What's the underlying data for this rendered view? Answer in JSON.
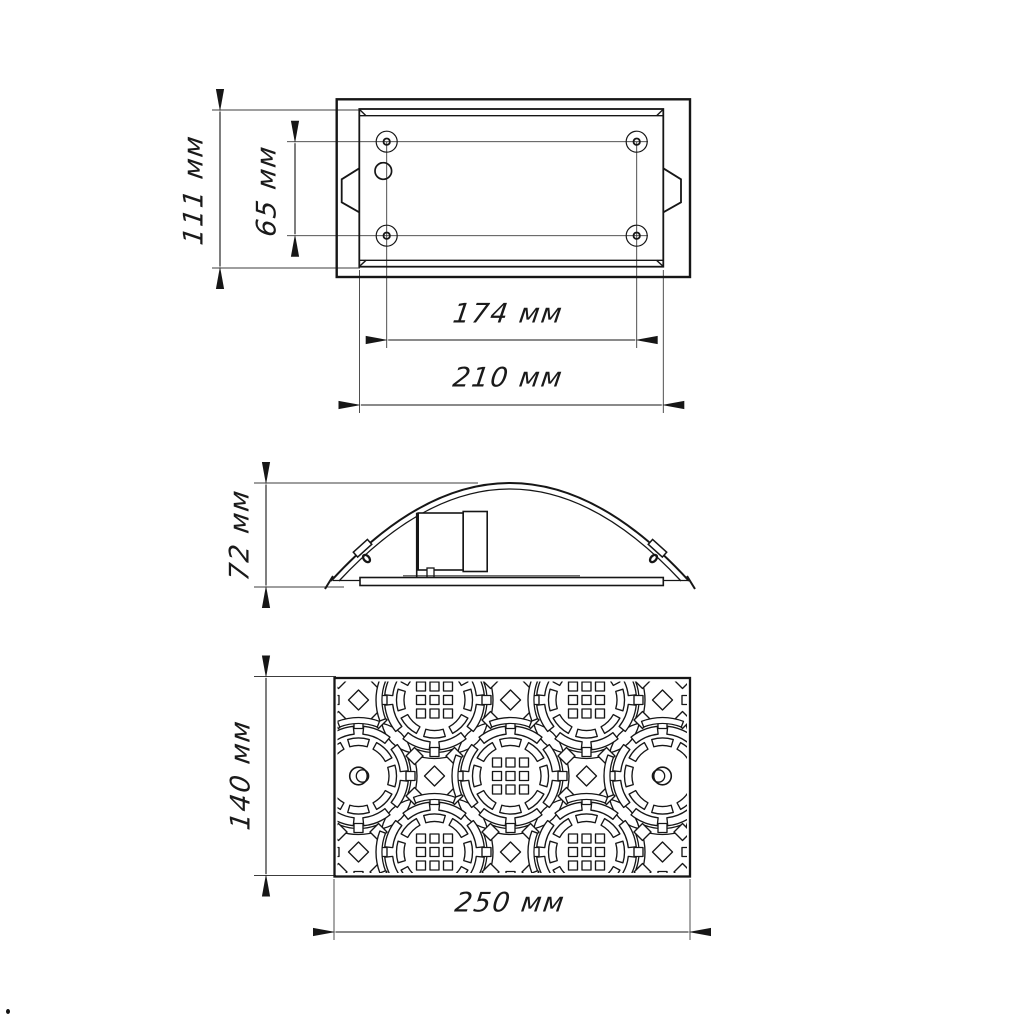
{
  "units": "мм",
  "colors": {
    "line": "#161616",
    "thin_line": "#3c3c3c",
    "background": "#ffffff"
  },
  "views": {
    "top_view": {
      "dimensions": {
        "body_height": {
          "label": "111 мм",
          "value": 111,
          "unit": "мм"
        },
        "hole_spacing_vertical": {
          "label": "65 мм",
          "value": 65,
          "unit": "мм"
        },
        "hole_spacing_horizontal": {
          "label": "174 мм",
          "value": 174,
          "unit": "мм"
        },
        "body_width": {
          "label": "210 мм",
          "value": 210,
          "unit": "мм"
        }
      }
    },
    "side_view": {
      "dimensions": {
        "profile_height": {
          "label": "72 мм",
          "value": 72,
          "unit": "мм"
        }
      }
    },
    "front_view": {
      "dimensions": {
        "grille_height": {
          "label": "140 мм",
          "value": 140,
          "unit": "мм"
        },
        "grille_width": {
          "label": "250 мм",
          "value": 250,
          "unit": "мм"
        }
      }
    }
  }
}
